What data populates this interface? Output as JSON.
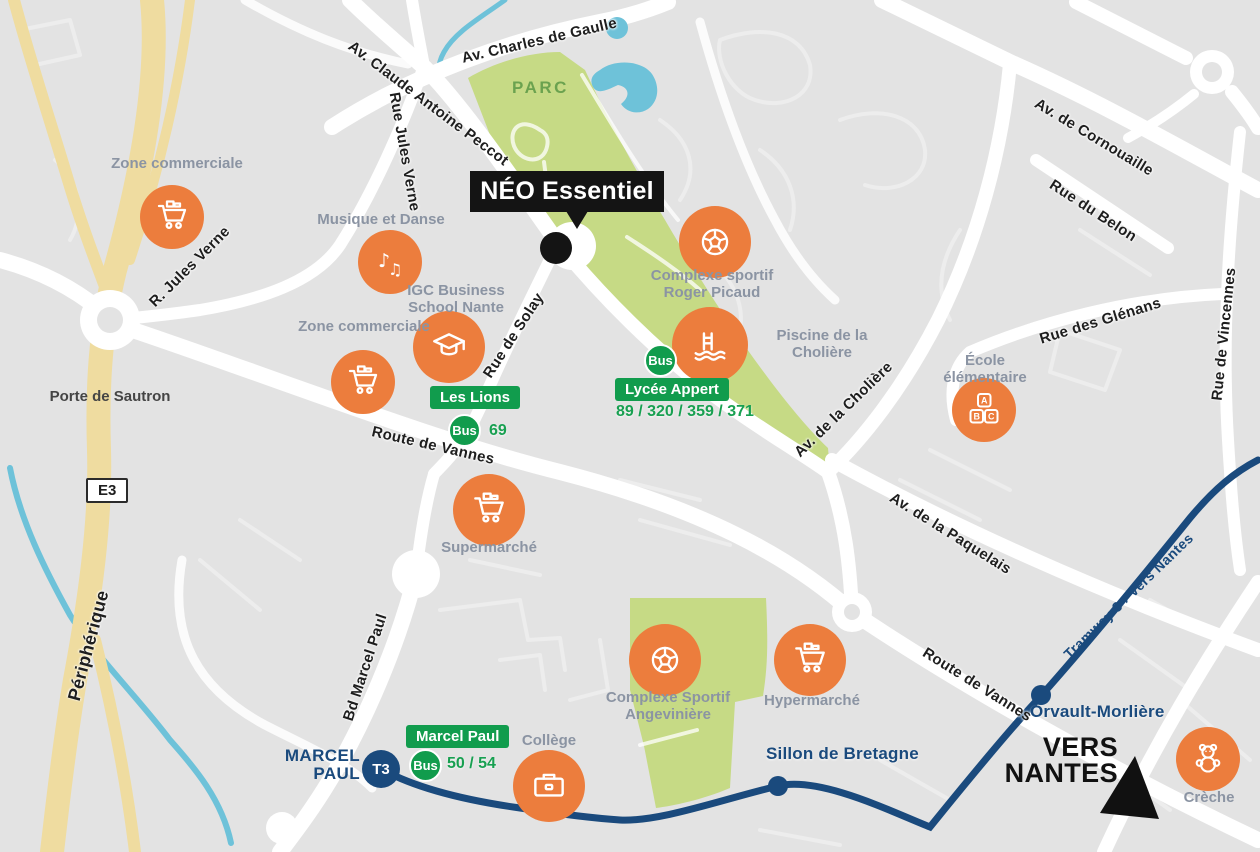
{
  "map": {
    "project_label": "NÉO Essentiel",
    "park_label": "PARC",
    "highway_shield": "E3",
    "interchange_label": "Porte de Sautron",
    "roads": {
      "charles_de_gaulle": "Av. Charles de Gaulle",
      "claude_antoine_peccot": "Av. Claude Antoine Peccot",
      "rue_jules_verne": "Rue Jules Verne",
      "r_jules_verne": "R. Jules Verne",
      "rue_de_solay": "Rue de Solay",
      "route_de_vannes_1": "Route de Vannes",
      "route_de_vannes_2": "Route de Vannes",
      "av_de_la_choliere": "Av. de la Cholière",
      "av_de_cornouaille": "Av. de Cornouaille",
      "rue_du_belon": "Rue du Belon",
      "rue_des_glenans": "Rue des Glénans",
      "rue_de_vincennes": "Rue de Vincennes",
      "av_de_la_paquelais": "Av. de la Paquelais",
      "bd_marcel_paul": "Bd Marcel Paul",
      "peripherique": "Périphérique"
    },
    "pois": {
      "zone_commerciale_nord": "Zone commerciale",
      "musique_et_danse": "Musique et Danse",
      "igc_business": "IGC Business School Nante",
      "zone_commerciale_ouest": "Zone commerciale",
      "complexe_roger_picaud": "Complexe sportif Roger Picaud",
      "piscine_choliere": "Piscine de la Cholière",
      "ecole_elementaire": "École élémentaire",
      "supermarche": "Supermarché",
      "complexe_angeviniere": "Complexe Sportif Angevinière",
      "hypermarche": "Hypermarché",
      "college": "Collège",
      "creche": "Crèche"
    },
    "transit": {
      "bus_badge": "Bus",
      "stops": {
        "les_lions": {
          "name": "Les Lions",
          "lines": "69"
        },
        "lycee_appert": {
          "name": "Lycée Appert",
          "lines": "89 / 320 / 359 / 371"
        },
        "marcel_paul": {
          "name": "Marcel Paul",
          "lines": "50 / 54"
        }
      },
      "tram": {
        "line_badge": "T3",
        "terminus": {
          "line1": "MARCEL",
          "line2": "PAUL"
        },
        "stations": {
          "sillon": "Sillon de Bretagne",
          "orvault": "Orvault-Morlière"
        },
        "line_label": "Tramway 3 › Vers Nantes",
        "direction": {
          "line1": "VERS",
          "line2": "NANTES"
        }
      }
    },
    "icons": {
      "abc_letters": [
        "A",
        "B",
        "C"
      ],
      "music_notes": [
        "♪",
        "♫"
      ]
    },
    "colors": {
      "accent_orange": "#EC7D3D",
      "transit_green": "#119C4D",
      "tram_navy": "#1A4A7D",
      "park_green": "#C6DA85",
      "water_blue": "#6EC2D9",
      "highway_yellow": "#EFDCA0",
      "marker_black": "#141414",
      "poi_gray": "#8B94A3"
    }
  }
}
